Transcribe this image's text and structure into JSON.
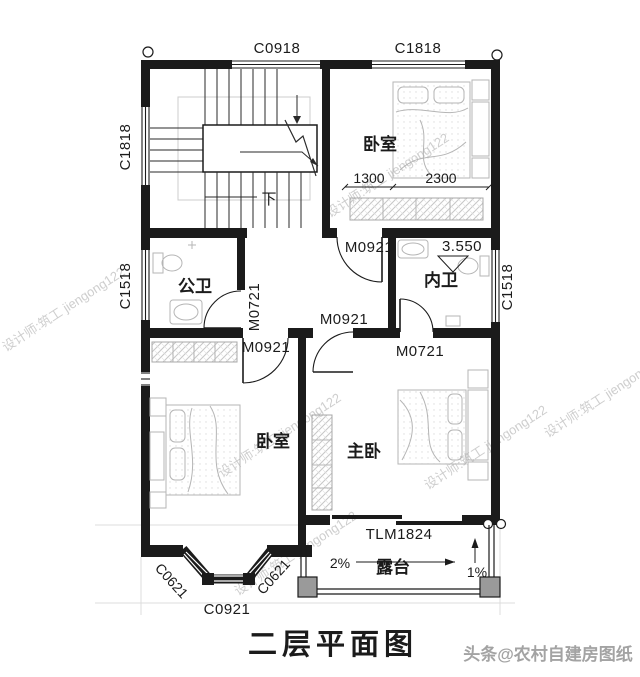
{
  "plan": {
    "title": "二层平面图",
    "rooms": {
      "bedroom_top": "卧室",
      "public_bath": "公卫",
      "ensuite_bath": "内卫",
      "bedroom_left": "卧室",
      "master_bedroom": "主卧",
      "terrace": "露台"
    },
    "windows": {
      "top_stair": "C0918",
      "top_bedroom": "C1818",
      "left_stair": "C1818",
      "left_bath": "C1518",
      "right_bath": "C1518",
      "bay_left": "C0621",
      "bay_front": "C0921",
      "bay_right": "C0621"
    },
    "doors": {
      "bedroom_top": "M0921",
      "public_bath": "M0721",
      "master_entry": "M0921",
      "bedroom_left": "M0921",
      "ensuite_bath": "M0721",
      "terrace_sliding": "TLM1824"
    },
    "dimensions": {
      "bedroom_width_left": "1300",
      "bedroom_width_right": "2300",
      "floor_elevation": "3.550",
      "terrace_slope_main": "2%",
      "terrace_slope_side": "1%"
    },
    "stairs": {
      "down_label": "下"
    },
    "watermark": {
      "designer": "设计师:筑工 jiengong122",
      "credit": "头条@农村自建房图纸"
    },
    "colors": {
      "wall": "#1b1b1b",
      "furniture": "#b5b5b5",
      "guide": "#d9d9d9"
    }
  }
}
